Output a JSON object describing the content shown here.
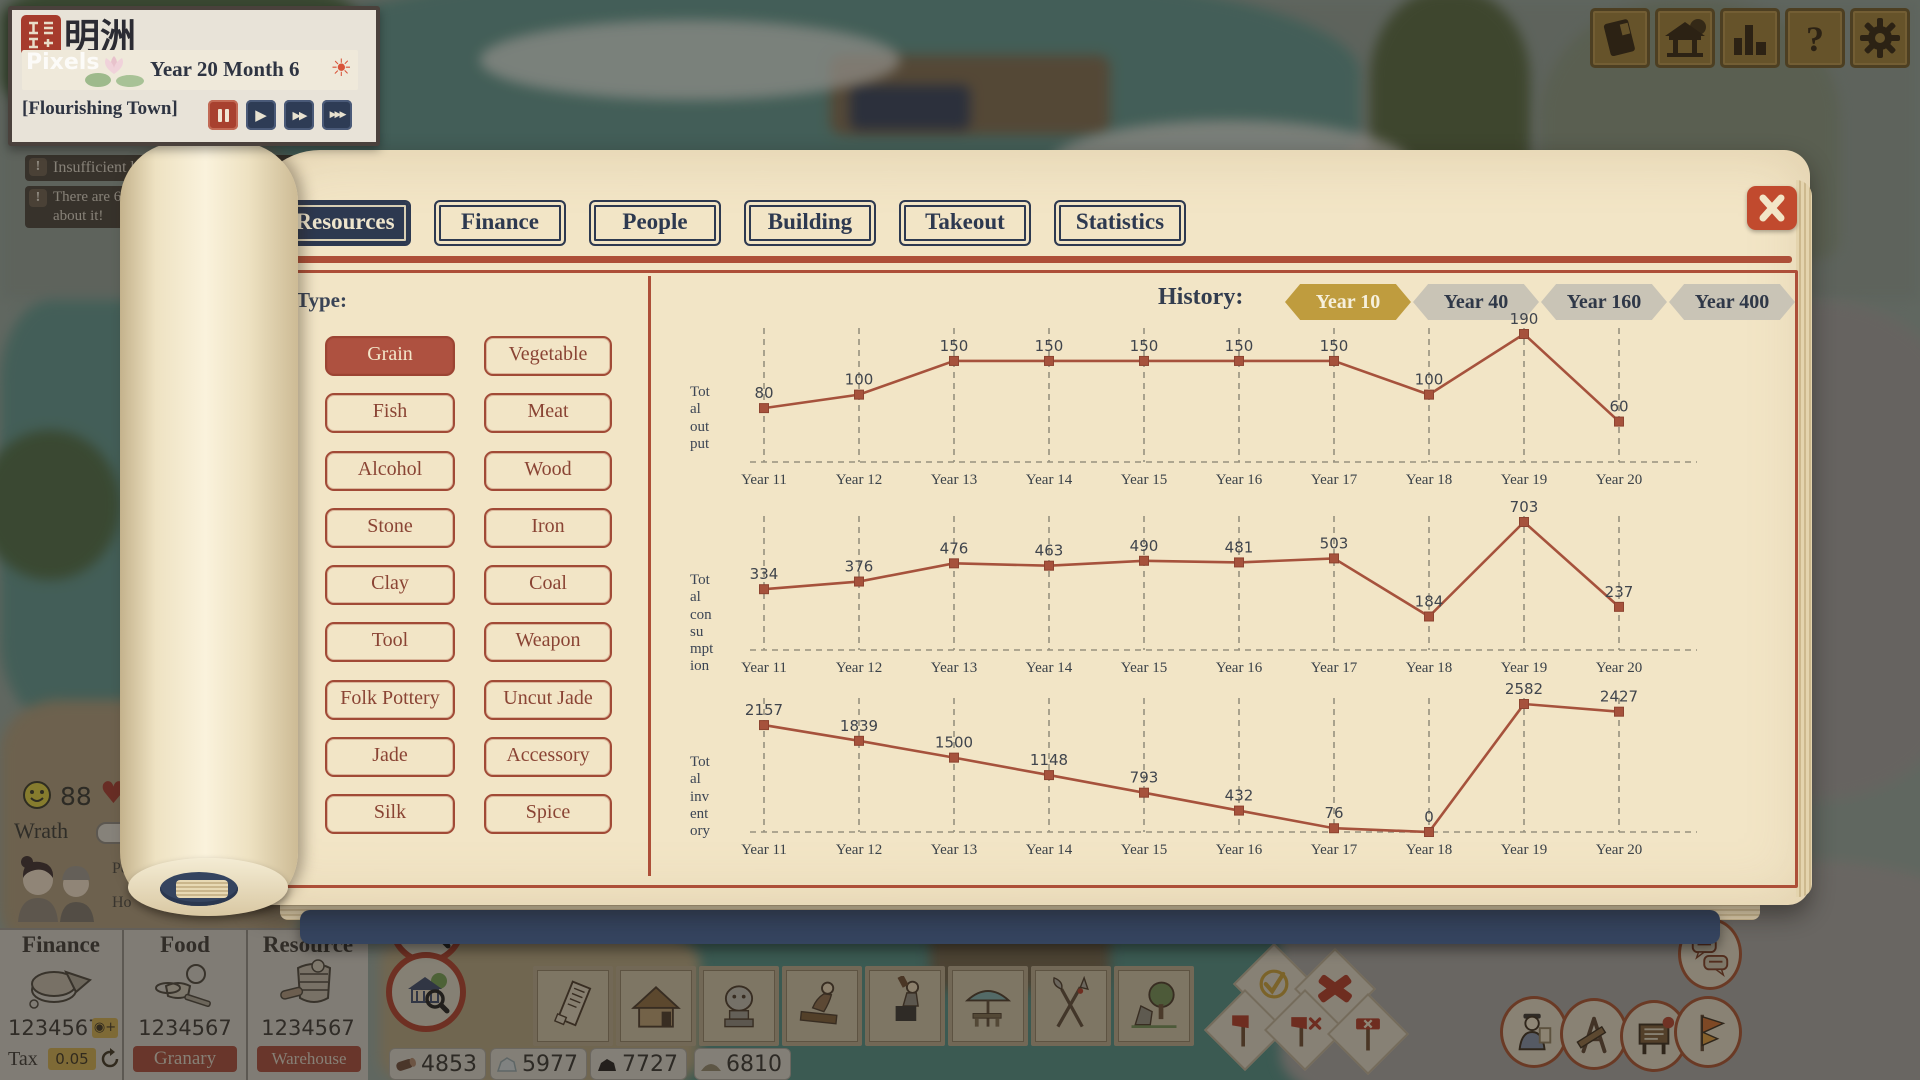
{
  "hud": {
    "town_name": "明洲",
    "date": "Year 20 Month 6",
    "title": "[Flourishing Town]",
    "watermark": "Pixels"
  },
  "notifications": {
    "toast1_left": "Insufficient ho",
    "toast1_right": "ccept more people",
    "toast2_line1": "There are 6 ru",
    "toast2_line2": "about it!"
  },
  "topbar": {
    "icons": [
      "book-icon",
      "shrine-icon",
      "chart-icon",
      "help-icon",
      "settings-icon"
    ]
  },
  "panel": {
    "tabs": [
      {
        "label": "Resources",
        "selected": true
      },
      {
        "label": "Finance",
        "selected": false
      },
      {
        "label": "People",
        "selected": false
      },
      {
        "label": "Building",
        "selected": false
      },
      {
        "label": "Takeout",
        "selected": false
      },
      {
        "label": "Statistics",
        "selected": false
      }
    ],
    "type_section": {
      "label": "Type:",
      "options": [
        {
          "label": "Grain",
          "selected": true
        },
        {
          "label": "Vegetable",
          "selected": false
        },
        {
          "label": "Fish",
          "selected": false
        },
        {
          "label": "Meat",
          "selected": false
        },
        {
          "label": "Alcohol",
          "selected": false
        },
        {
          "label": "Wood",
          "selected": false
        },
        {
          "label": "Stone",
          "selected": false
        },
        {
          "label": "Iron",
          "selected": false
        },
        {
          "label": "Clay",
          "selected": false
        },
        {
          "label": "Coal",
          "selected": false
        },
        {
          "label": "Tool",
          "selected": false
        },
        {
          "label": "Weapon",
          "selected": false
        },
        {
          "label": "Folk Pottery",
          "selected": false
        },
        {
          "label": "Uncut Jade",
          "selected": false
        },
        {
          "label": "Jade",
          "selected": false
        },
        {
          "label": "Accessory",
          "selected": false
        },
        {
          "label": "Silk",
          "selected": false
        },
        {
          "label": "Spice",
          "selected": false
        }
      ]
    },
    "history": {
      "label": "History:",
      "options": [
        {
          "label": "Year 10",
          "selected": true
        },
        {
          "label": "Year 40",
          "selected": false
        },
        {
          "label": "Year 160",
          "selected": false
        },
        {
          "label": "Year 400",
          "selected": false
        }
      ]
    }
  },
  "chart_data": [
    {
      "type": "line",
      "title": "Total output",
      "title_lines": [
        "Tot",
        "al",
        "out",
        "put"
      ],
      "x": [
        "Year 11",
        "Year 12",
        "Year 13",
        "Year 14",
        "Year 15",
        "Year 16",
        "Year 17",
        "Year 18",
        "Year 19",
        "Year 20"
      ],
      "values": [
        80,
        100,
        150,
        150,
        150,
        150,
        150,
        100,
        190,
        60
      ],
      "ylim": [
        0,
        200
      ],
      "line_color": "#a6523c",
      "marker": "square",
      "grid": "dashed"
    },
    {
      "type": "line",
      "title": "Total consumption",
      "title_lines": [
        "Tot",
        "al",
        "con",
        "su",
        "mpt",
        "ion"
      ],
      "x": [
        "Year 11",
        "Year 12",
        "Year 13",
        "Year 14",
        "Year 15",
        "Year 16",
        "Year 17",
        "Year 18",
        "Year 19",
        "Year 20"
      ],
      "values": [
        334,
        376,
        476,
        463,
        490,
        481,
        503,
        184,
        703,
        237
      ],
      "ylim": [
        0,
        740
      ],
      "line_color": "#a6523c",
      "marker": "square",
      "grid": "dashed"
    },
    {
      "type": "line",
      "title": "Total inventory",
      "title_lines": [
        "Tot",
        "al",
        "inv",
        "ent",
        "ory"
      ],
      "x": [
        "Year 11",
        "Year 12",
        "Year 13",
        "Year 14",
        "Year 15",
        "Year 16",
        "Year 17",
        "Year 18",
        "Year 19",
        "Year 20"
      ],
      "values": [
        2157,
        1839,
        1500,
        1148,
        793,
        432,
        76,
        0,
        2582,
        2427
      ],
      "ylim": [
        0,
        2720
      ],
      "line_color": "#a6523c",
      "marker": "square",
      "grid": "dashed"
    }
  ],
  "status": {
    "happiness": "88",
    "wrath_label": "Wrath",
    "people_fragment": "Pe",
    "house_fragment": "Ho"
  },
  "stats_panels": {
    "finance": {
      "title": "Finance",
      "value": "1234567",
      "tax_label": "Tax",
      "tax_value": "0.05"
    },
    "food": {
      "title": "Food",
      "value": "1234567",
      "button": "Granary"
    },
    "resource": {
      "title": "Resource",
      "value": "1234567",
      "button": "Warehouse"
    }
  },
  "resource_bar": [
    {
      "icon": "log-icon",
      "value": "4853"
    },
    {
      "icon": "stone-icon",
      "value": "5977"
    },
    {
      "icon": "coal-icon",
      "value": "7727"
    },
    {
      "icon": "clay-icon",
      "value": "6810"
    }
  ],
  "toolbar": {
    "cards": [
      "scroll-card",
      "hut-card",
      "lion-statue-card",
      "carpenter-card",
      "blacksmith-card",
      "stall-card",
      "weapons-card",
      "garden-card"
    ],
    "zoom_buttons": [
      "livestock-zoom-icon",
      "house-zoom-icon"
    ]
  },
  "map_actions": {
    "diamonds": [
      "confirm-check-icon",
      "cancel-cross-icon",
      "demolish-axe-icon",
      "demolish-axe-x-icon",
      "demolish-hammer-icon"
    ],
    "medallions": [
      "chat-bubbles-icon",
      "official-icon",
      "planning-tools-icon",
      "notice-board-icon",
      "banner-flag-icon"
    ]
  },
  "colors": {
    "accent_red": "#ad4f38",
    "navy": "#2d3950",
    "gold": "#bf9c3e",
    "page": "#f2e5c6",
    "chart_line": "#a6523c"
  }
}
